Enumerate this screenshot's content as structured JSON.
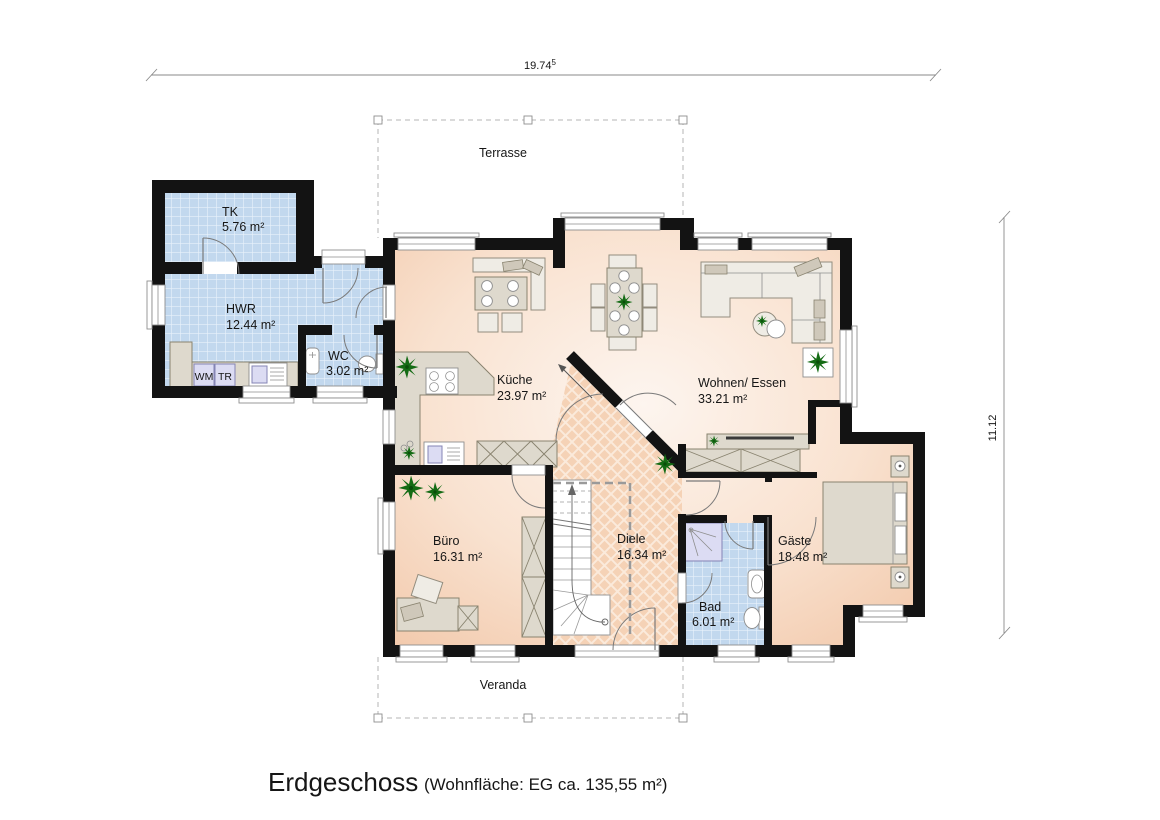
{
  "dimensions": {
    "width_label": {
      "value": "19.74",
      "superscript": "5"
    },
    "height_label": "11.12"
  },
  "outdoor_areas": {
    "terrace": "Terrasse",
    "veranda": "Veranda"
  },
  "rooms": {
    "tk": {
      "name": "TK",
      "area": "5.76 m²"
    },
    "hwr": {
      "name": "HWR",
      "area": "12.44 m²"
    },
    "wc": {
      "name": "WC",
      "area": "3.02 m²"
    },
    "kueche": {
      "name": "Küche",
      "area": "23.97 m²"
    },
    "wohnen_essen": {
      "name": "Wohnen/ Essen",
      "area": "33.21 m²"
    },
    "buero": {
      "name": "Büro",
      "area": "16.31 m²"
    },
    "diele": {
      "name": "Diele",
      "area": "16.34 m²"
    },
    "bad": {
      "name": "Bad",
      "area": "6.01 m²"
    },
    "gaeste": {
      "name": "Gäste",
      "area": "18.48 m²"
    }
  },
  "appliances": {
    "washing_machine": "WM",
    "dryer": "TR"
  },
  "footer": {
    "floor_name": "Erdgeschoss",
    "living_area_note": "(Wohnfläche: EG  ca. 135,55 m²)"
  },
  "colors": {
    "wall": "#131313",
    "floor_peach": "#f4cdb1",
    "hall_floor": "#f5d2b6",
    "tile_blue": "#c2d8ee",
    "plant_green": "#146b14",
    "furniture": "#ded9cd"
  }
}
